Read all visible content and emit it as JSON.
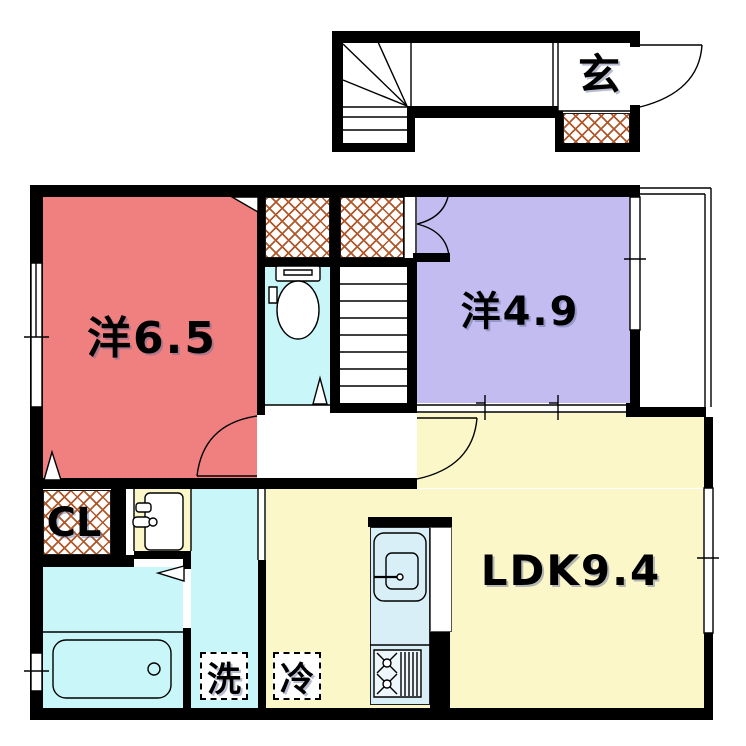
{
  "floorplan": {
    "labels": {
      "entrance": "玄",
      "western_room_6_5": "洋6.5",
      "western_room_4_9": "洋4.9",
      "ldk": "LDK9.4",
      "closet": "CL",
      "washing_machine": "洗",
      "refrigerator": "冷"
    },
    "colors": {
      "western_room_6_5": "#f08080",
      "western_room_4_9": "#c3bcf0",
      "ldk": "#fbf7c9",
      "wet_area": "#c9f7f9",
      "kitchen_counter": "#d8eff8",
      "hatch_lines": "#b1582b",
      "walls": "#000000"
    }
  }
}
